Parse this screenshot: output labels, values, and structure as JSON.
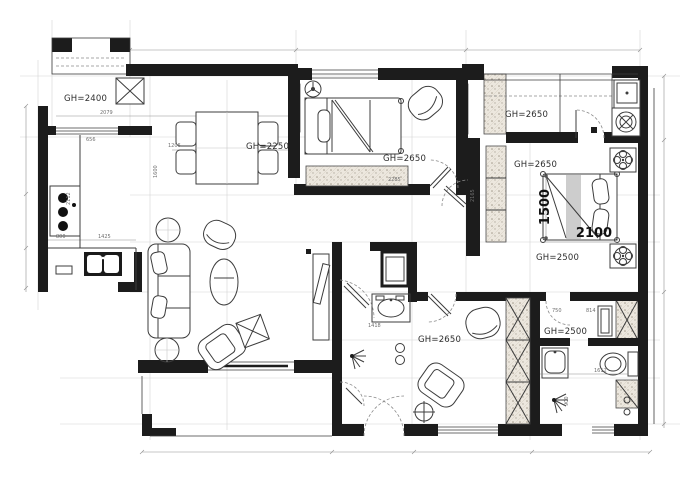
{
  "drawing_type": "apartment-floor-plan",
  "colors": {
    "wall": "#1c1c1c",
    "line": "#3c3c3c",
    "construction": "#c6c6c6",
    "dimension": "#8f8f8f",
    "label_text": "#2e2e2e",
    "hatch_bg": "#ece7de",
    "hatch_dot": "#a29a8c",
    "bed_stripe": "#cdcdcd"
  },
  "gh": {
    "balcony": "GH=2400",
    "laundry": "GH=2650",
    "dining": "GH=2250",
    "bedroom2": "GH=2650",
    "master_top": "GH=2650",
    "master_bottom": "GH=2500",
    "bedroom3": "GH=2650",
    "master_bath": "GH=2500"
  },
  "bed": {
    "width": "1500",
    "length": "2100"
  },
  "dims": {
    "kitchen_top": "2079",
    "balcony_door": "656",
    "dining_width": "1206",
    "counter_left": "800",
    "counter_bottom": "1425",
    "kitchen_depth": "2112",
    "hall_height": "1600",
    "wardrobe_b2": "2285",
    "basin": "1418",
    "mbath_width": "1612",
    "mbath_depth": "900",
    "vanity_left": "750",
    "vanity_right": "814",
    "master_side": "2165"
  }
}
